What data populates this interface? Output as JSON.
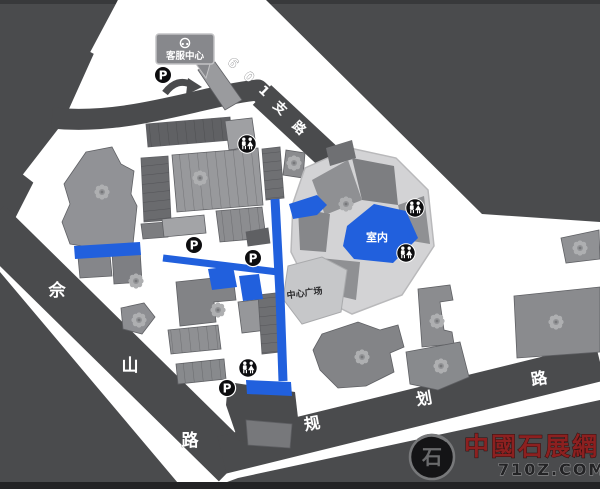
{
  "roads": {
    "branch_601": {
      "name": "601支路"
    },
    "sheshan": {
      "name": "佘山路"
    },
    "guihua": {
      "name": "规划路"
    }
  },
  "labels": {
    "service_center": "客服中心",
    "central_plaza": "中心广场",
    "indoor_area": "室内",
    "parking": "P"
  },
  "badges": {
    "parking_count": 4,
    "toilet_count": 4
  },
  "watermark": {
    "site_name": "中國石展網",
    "site_url": "710Z.COM",
    "emblem_char": "石"
  },
  "colors": {
    "background_road": "#4a4b4d",
    "land": "#ffffff",
    "highlight_blue": "#2160dd",
    "building_gray": "#8f9093",
    "watermark_red": "#8c2020",
    "badge_black": "#0d0d0f"
  }
}
